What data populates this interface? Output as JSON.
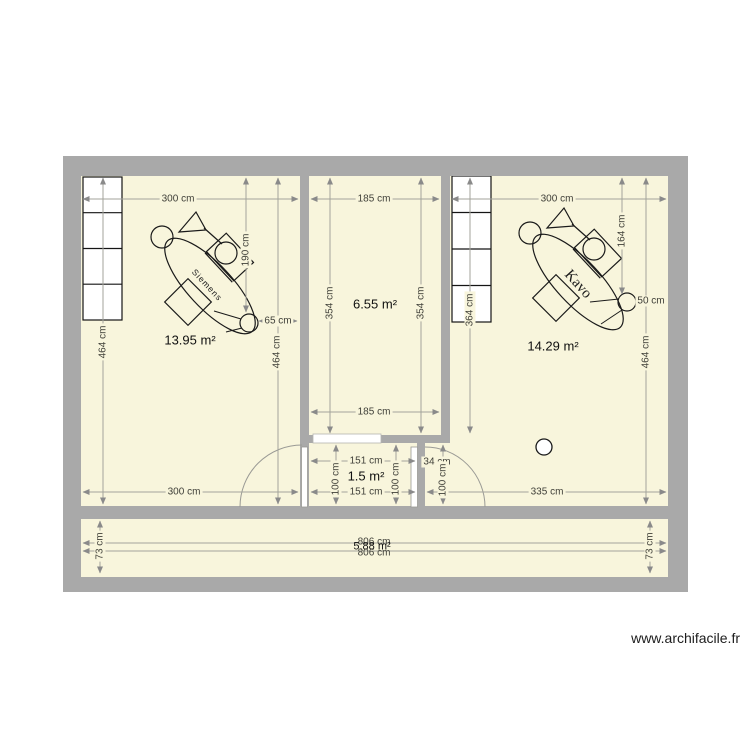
{
  "watermark": "www.archifacile.fr",
  "colors": {
    "floor": "#f8f5dc",
    "wall": "#a9a9a9",
    "dim_line": "#a3a39b",
    "arrow": "#8a8a8a",
    "dim_text": "#3f3f38",
    "label_text": "#101010",
    "drawing_stroke": "#1a1a1a"
  },
  "rooms": {
    "left": {
      "label": "13.95 m²",
      "dim_top": "300 cm",
      "dim_bottom": "300 cm",
      "dim_left": "464 cm",
      "dim_right": "464 cm",
      "dim_chair": "190 cm",
      "dim_foot": "65 cm",
      "chair_brand": "Siemens"
    },
    "middle": {
      "label": "6.55 m²",
      "dim_top": "185 cm",
      "dim_bottom": "185 cm",
      "dim_left": "354 cm",
      "dim_right": "354 cm"
    },
    "right": {
      "label": "14.29 m²",
      "dim_top": "300 cm",
      "dim_bottom": "335 cm",
      "dim_cabinet": "364 cm",
      "dim_chair": "164 cm",
      "dim_foot": "50 cm",
      "dim_right": "464 cm",
      "chair_brand": "Kavo"
    },
    "wc": {
      "label": "1.5 m²",
      "dim_top": "151 cm",
      "dim_bottom": "151 cm",
      "dim_left": "100 cm",
      "dim_right": "100 cm",
      "niche_width": "34 cm",
      "niche_height": "100 cm"
    },
    "corridor": {
      "label": "5.88 m²",
      "dim_top": "806 cm",
      "dim_bottom": "806 cm",
      "dim_left": "73 cm",
      "dim_right": "73 cm"
    }
  }
}
